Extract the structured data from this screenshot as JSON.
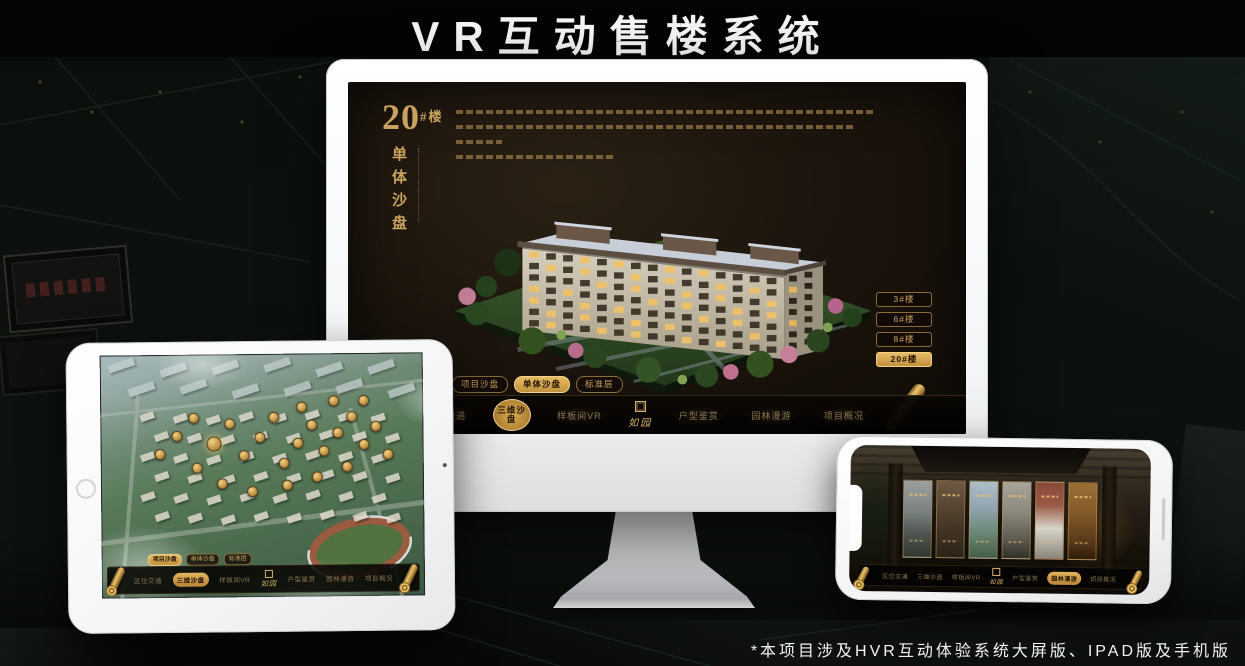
{
  "title": "VR互动售楼系统",
  "footnote": "*本项目涉及HVR互动体验系统大屏版、IPAD版及手机版",
  "brand": {
    "logo_text": "如园"
  },
  "colors": {
    "accent_gold": "#C9A25F",
    "active_gold": "#D9A94F",
    "screen_bg": "#1A130C",
    "menu_bar_bg": "#0A0705",
    "title_white": "#F5F5F5"
  },
  "icons": {
    "scroll": "scroll-nav-icon",
    "seal": "brand-seal-icon"
  },
  "monitor": {
    "headline_number": "20",
    "headline_suffix": "#楼",
    "headline_vertical": "单体沙盘",
    "floor_buttons": [
      {
        "label": "3#楼",
        "active": false
      },
      {
        "label": "6#楼",
        "active": false
      },
      {
        "label": "8#楼",
        "active": false
      },
      {
        "label": "20#楼",
        "active": true
      }
    ],
    "tabs": [
      {
        "label": "项目沙盘",
        "active": false
      },
      {
        "label": "单体沙盘",
        "active": true
      },
      {
        "label": "标准层",
        "active": false
      }
    ],
    "menu_left": [
      {
        "label": "区位交通",
        "active": false
      },
      {
        "label": "三维沙盘",
        "active": true
      },
      {
        "label": "样板间VR",
        "active": false
      }
    ],
    "menu_right": [
      {
        "label": "户型鉴赏",
        "active": false
      },
      {
        "label": "园林漫游",
        "active": false
      },
      {
        "label": "项目概况",
        "active": false
      }
    ]
  },
  "tablet": {
    "tabs": [
      {
        "label": "项目沙盘",
        "active": true
      },
      {
        "label": "单体沙盘",
        "active": false
      },
      {
        "label": "标准层",
        "active": false
      }
    ],
    "menu_left": [
      {
        "label": "区位交通",
        "active": false
      },
      {
        "label": "三维沙盘",
        "active": true
      },
      {
        "label": "样板间VR",
        "active": false
      }
    ],
    "menu_right": [
      {
        "label": "户型鉴赏",
        "active": false
      },
      {
        "label": "园林漫游",
        "active": false
      },
      {
        "label": "项目概况",
        "active": false
      }
    ]
  },
  "phone": {
    "menu_left": [
      {
        "label": "区位交通",
        "active": false
      },
      {
        "label": "三维沙盘",
        "active": false
      },
      {
        "label": "样板间VR",
        "active": false
      }
    ],
    "menu_right": [
      {
        "label": "户型鉴赏",
        "active": false
      },
      {
        "label": "园林漫游",
        "active": true
      },
      {
        "label": "项目概况",
        "active": false
      }
    ]
  }
}
